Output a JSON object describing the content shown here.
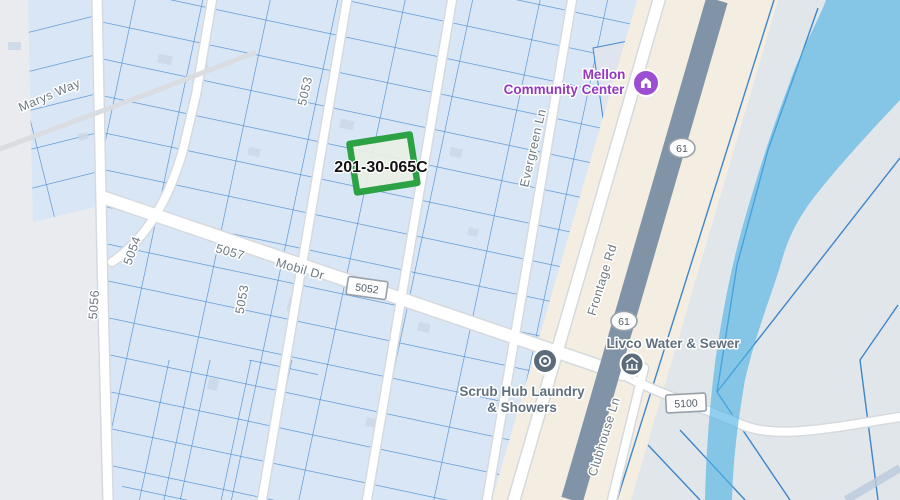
{
  "map": {
    "parcel": {
      "id": "201-30-065C",
      "stroke_color": "#2ca244",
      "fill_color": "#e9f0e4"
    },
    "street_labels": {
      "marys_way": "Marys Way",
      "r5053_top": "5053",
      "r5053_bottom": "5053",
      "r5054": "5054",
      "r5056": "5056",
      "r5057": "5057",
      "mobil_dr": "Mobil Dr",
      "evergreen_ln": "Evergreen Ln",
      "frontage_rd": "Frontage Rd",
      "clubhouse_ln": "Clubhouse Ln"
    },
    "shields": {
      "s5052": "5052",
      "s5100": "5100",
      "hwy61_north": "61",
      "hwy61_south": "61"
    },
    "pois": [
      {
        "line1": "Mellon",
        "line2": "Community Center",
        "icon": "community-center-icon",
        "color": "#9537c0"
      },
      {
        "line1": "Livco Water & Sewer",
        "icon": "water-utility-icon",
        "color": "#60707f"
      },
      {
        "line1": "Scrub Hub Laundry",
        "line2": "& Showers",
        "icon": "laundry-icon",
        "color": "#60707f"
      }
    ],
    "colors": {
      "land_west": "#e9ebee",
      "land_east": "#e0e6ea",
      "parcel_fill": "#d9e6f6",
      "parcel_line": "#4187cb",
      "road_fill": "#ffffff",
      "road_casing": "#d6dade",
      "highway_corridor": "#f3eee1",
      "highway_fill": "#8193a7",
      "water": "#5db9e7",
      "poi_pin_slate": "#5c6b79",
      "poi_pin_purple": "#9d4fd4",
      "highlight_green": "#2ca244"
    }
  }
}
